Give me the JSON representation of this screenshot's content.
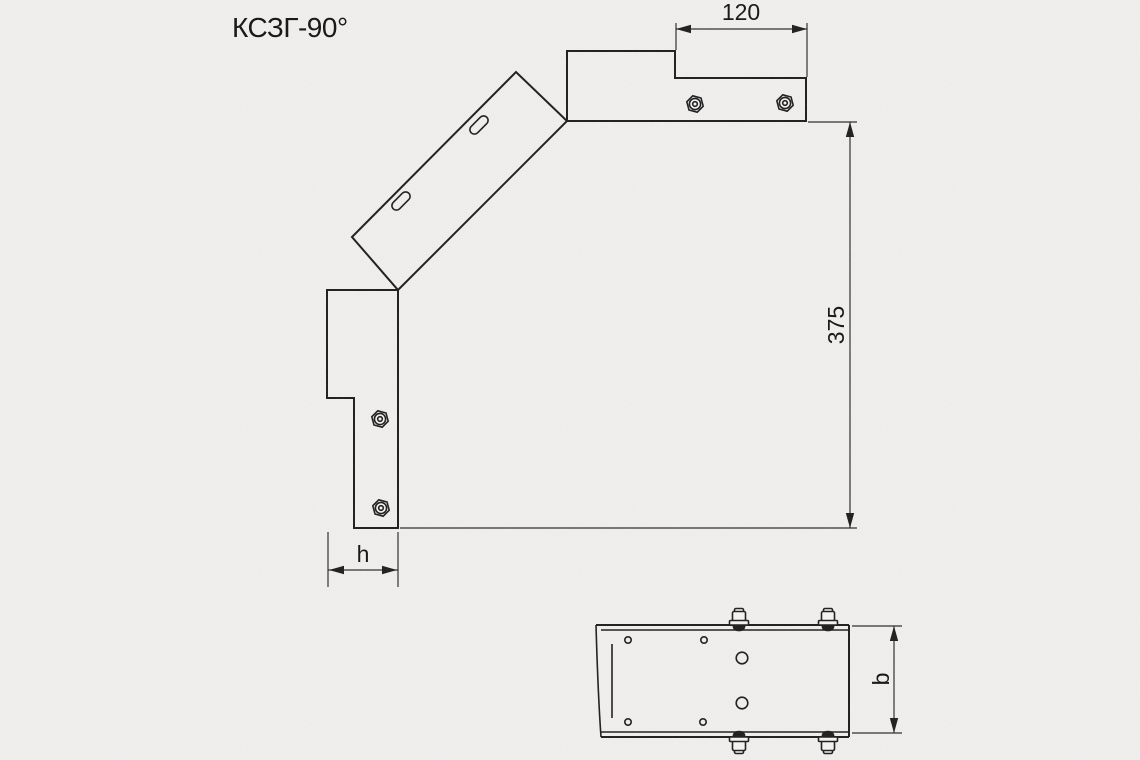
{
  "drawing": {
    "title": "КСЗГ-90°",
    "front_view": {
      "dim_top_width": "120",
      "dim_overall_height": "375",
      "dim_side_height": "h"
    },
    "plan_view": {
      "dim_tray_width": "b"
    }
  },
  "colors": {
    "line": "#1a1a1a",
    "thin": "#2a2a2a",
    "background": "#f2f1ee"
  }
}
